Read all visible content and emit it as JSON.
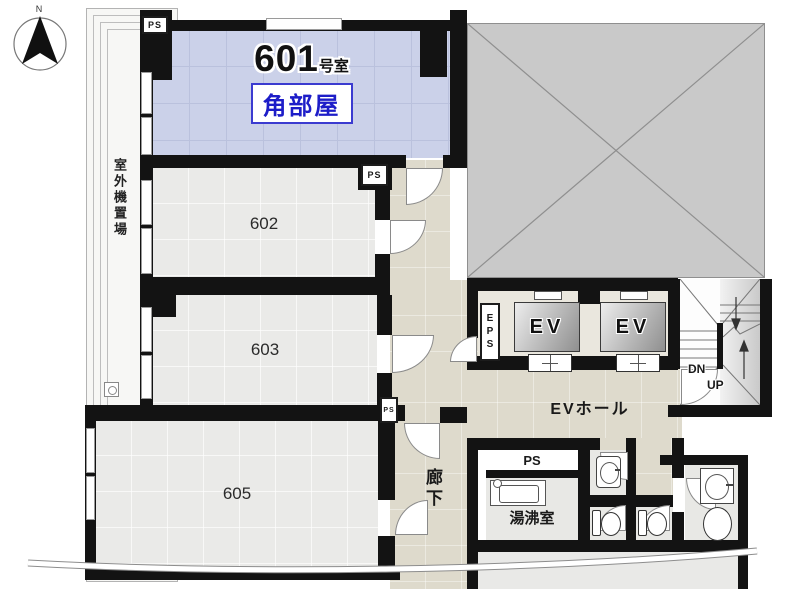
{
  "compass": {
    "north": "N"
  },
  "rooms": {
    "r601": {
      "number": "601",
      "suffix": "号室",
      "badge": "角部屋"
    },
    "r602": {
      "number": "602"
    },
    "r603": {
      "number": "603"
    },
    "r605": {
      "number": "605"
    }
  },
  "labels": {
    "outdoor_unit": "室外機置場",
    "corridor": "廊下",
    "ev_hall": "EVホール",
    "elevator": "EV",
    "eps": "EPS",
    "ps": "PS",
    "kitchenette": "湯沸室",
    "down": "DN",
    "up": "UP"
  },
  "colors": {
    "room601_fill": "#cbd1e9",
    "badge_text": "#1d1dc8",
    "badge_border": "#3b3bd0",
    "room_fill": "#eaeae8",
    "corridor_fill": "#dedacc",
    "void_fill": "#c9c9c9",
    "wall": "#131313"
  }
}
